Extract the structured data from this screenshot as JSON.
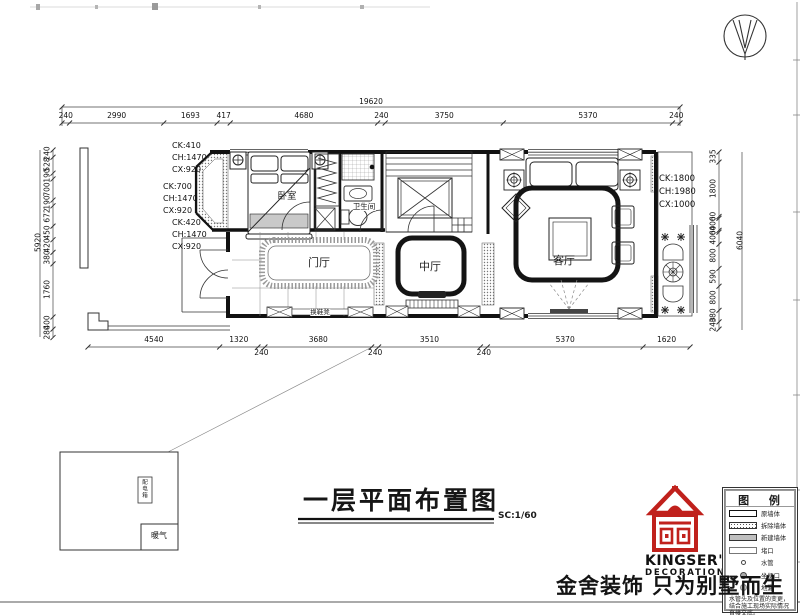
{
  "title_block": {
    "title": "一层平面布置图",
    "scale": "SC:1/60"
  },
  "rooms": {
    "bedroom": "卧室",
    "bathroom": "卫生间",
    "entry_hall": "门厅",
    "middle_hall": "中厅",
    "living_room": "客厅"
  },
  "labels": {
    "shoe_bench": "换鞋凳",
    "radiator": "暖气",
    "distribution_box": "配电箱"
  },
  "window_annotations": {
    "bedroom_top": [
      "CK:410",
      "CH:1470",
      "CX:920"
    ],
    "bedroom_left": [
      "CK:700",
      "CH:1470",
      "CX:920"
    ],
    "bedroom_bottom": [
      "CK:420",
      "CH:1470",
      "CX:920"
    ],
    "living_right": [
      "CK:1800",
      "CH:1980",
      "CX:1000"
    ]
  },
  "dimensions": {
    "top_total": "19620",
    "top_segments": [
      "240",
      "2990",
      "1693",
      "417",
      "4680",
      "240",
      "3750",
      "5370",
      "240"
    ],
    "bottom_segments": [
      "4540",
      "1320",
      "240",
      "3680",
      "240",
      "3510",
      "240",
      "5370",
      "1620"
    ],
    "left_total": "5920",
    "left_segments": [
      "240",
      "528",
      "190",
      "700",
      "190",
      "672",
      "450",
      "420",
      "380",
      "1760",
      "400",
      "280"
    ],
    "right_total": "6040",
    "right_segments": [
      "335",
      "1800",
      "60",
      "400",
      "60",
      "400",
      "800",
      "590",
      "800",
      "380",
      "240"
    ]
  },
  "legend": {
    "title": "图 例",
    "items": [
      {
        "key": "original-wall",
        "label": "原墙体"
      },
      {
        "key": "demolish-wall",
        "label": "拆除墙体"
      },
      {
        "key": "new-wall",
        "label": "新建墙体"
      },
      {
        "key": "seal-opening",
        "label": "堵口"
      },
      {
        "key": "water-pipe",
        "label": "水管"
      },
      {
        "key": "toilet-outlet",
        "label": "坐便口"
      },
      {
        "key": "floor-drain",
        "label": "地漏"
      }
    ],
    "note": "水管头及位置的变更，结合施工现场实际情况直接交底。"
  },
  "brand": {
    "logo_line1": "KINGSER'",
    "logo_line2": "DECORATION",
    "tagline": "金舍装饰 只为别墅而生"
  },
  "colors": {
    "line": "#1b1b1b",
    "brand_red": "#c0211c",
    "hatch": "#888888",
    "new_wall_fill": "#c4c4c4"
  }
}
